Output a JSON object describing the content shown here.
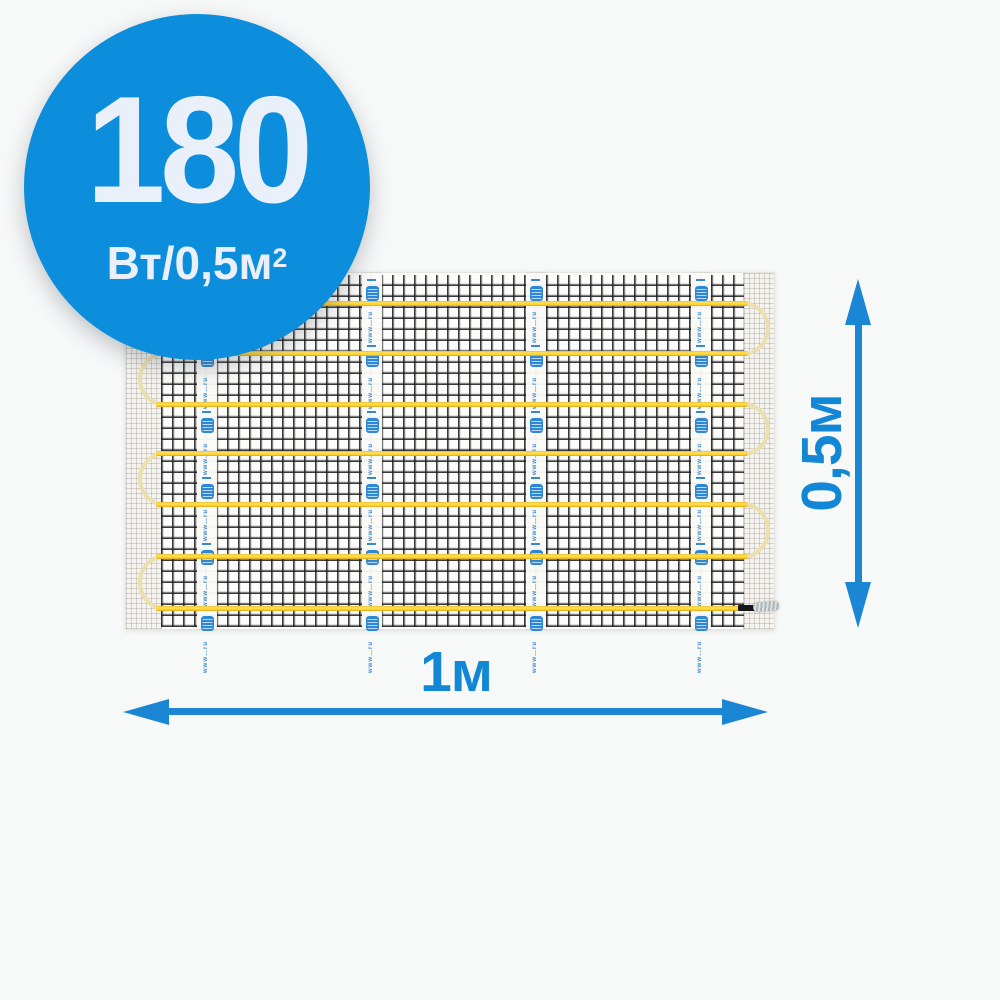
{
  "badge": {
    "power_value": "180",
    "power_unit": "Вт/0,5м",
    "power_unit_sup": "2",
    "circle_color": "#0c8edc",
    "text_color": "#e9f0fa"
  },
  "mat": {
    "description": "heating-mat-with-black-mesh-and-serpentine-yellow-cable",
    "cable_runs_count": 7,
    "tape_strips_count": 4,
    "cable_color": "#ffd42a",
    "loop_color": "#ecdfae",
    "mesh_line_color": "#1c1c1e",
    "tape_stamp_text": "www…ru",
    "tape_logo_color": "#2e86d6"
  },
  "dimensions": {
    "height_label": "0,5м",
    "width_label": "1м",
    "arrow_color": "#1b86d4"
  }
}
